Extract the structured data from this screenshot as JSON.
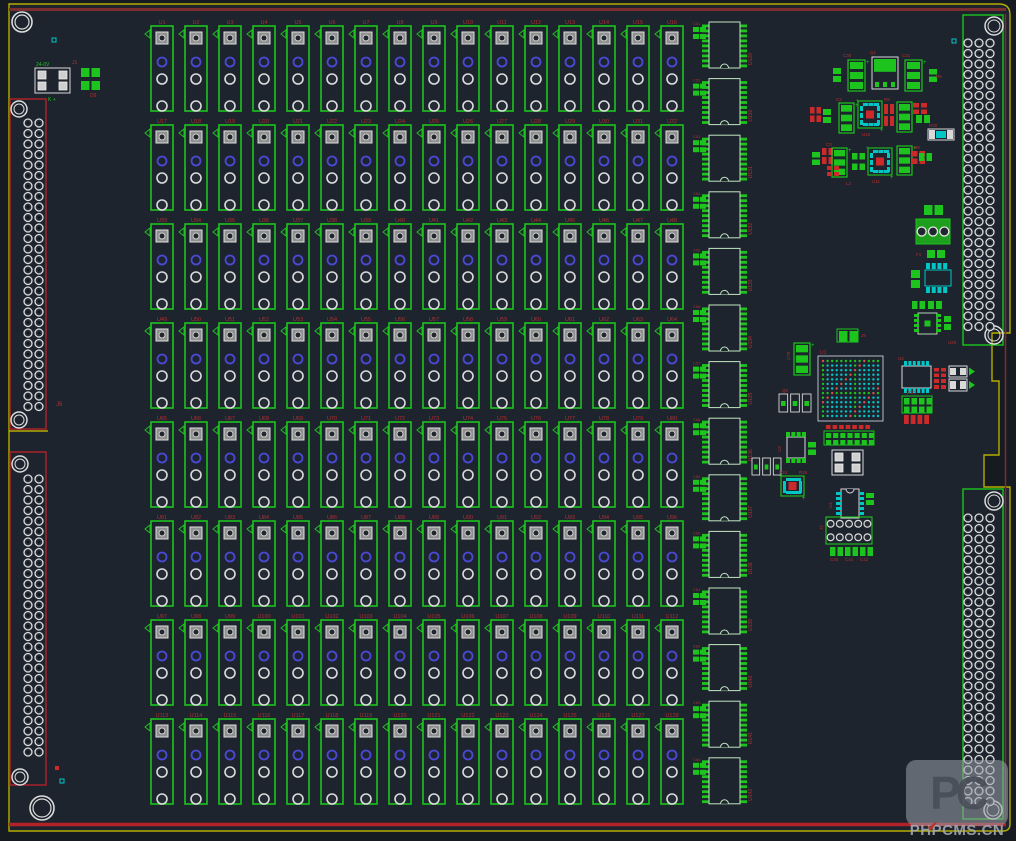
{
  "app": {
    "type": "pcb-layout-editor-canvas"
  },
  "colors": {
    "bg": "#1d242e",
    "outside": "#161b22",
    "green": "#1dc41d",
    "pale": "#c2e6c2",
    "cyan": "#00c6c6",
    "blue": "#4a49d6",
    "white": "#dcdcdc",
    "gray_pad": "#8f8f8f",
    "red_text": "#b03030",
    "red_pad": "#cc2a2a",
    "maroon": "#7c2e2e",
    "red_bright": "#b22228",
    "yellow": "#b5ab00",
    "body_outline": "#d9d9d9",
    "bga_outline": "#c9cfd6"
  },
  "watermark": {
    "logo": "PC",
    "text": "PHPCMS.CN"
  },
  "board": {
    "outline_yellow": "M 9 831 L 9 4 L 999 4 Q 1010 4 1010 15 L 1010 333 L 992 333 L 992 381 L 999 381 L 999 455 L 984 455 L 984 487 L 1010 487 L 1010 824 Q 1010 831 1003 831 Z",
    "notch_stub": "M 9 431 L 48 431",
    "red_top": [
      9,
      9.5,
      1006,
      9.5
    ],
    "red_bottom": [
      9,
      824.5,
      1006,
      824.5
    ],
    "red_right": [
      1005.5,
      14,
      1005.5,
      820
    ],
    "mount_holes": [
      [
        22,
        22,
        10
      ],
      [
        42,
        808,
        12
      ]
    ]
  },
  "relay_grid": {
    "cols": 16,
    "rows": 8,
    "x0": 151,
    "y0": 26,
    "col_pitch": 34,
    "row_pitch": 99,
    "box_w": 22,
    "box_h": 85,
    "ref_prefix": "U",
    "ref_start": 1
  },
  "dip_column": {
    "count": 14,
    "x": 709,
    "y0": 22,
    "pitch": 56.6,
    "body_w": 31,
    "body_h": 46,
    "pins_per_side": 9,
    "ref_prefix": "U",
    "ref_start": 129,
    "aux_prefix": "C",
    "aux_start": 51
  },
  "connectors": [
    {
      "name": "left-upper-connector",
      "box": [
        10,
        99,
        36,
        330
      ],
      "stroke": "red",
      "pad_cols": [
        28,
        39
      ],
      "pad_y0": 123,
      "pad_pitch": 10.5,
      "pad_rows": 28,
      "pad_r": 4,
      "holes": [
        [
          19,
          109,
          8
        ],
        [
          19,
          420,
          8
        ]
      ]
    },
    {
      "name": "left-lower-connector",
      "box": [
        10,
        452,
        36,
        333
      ],
      "stroke": "red",
      "pad_cols": [
        28,
        39
      ],
      "pad_y0": 479,
      "pad_pitch": 10.5,
      "pad_rows": 27,
      "pad_r": 4,
      "holes": [
        [
          20,
          464,
          8
        ],
        [
          20,
          777,
          8
        ]
      ]
    },
    {
      "name": "right-upper-connector",
      "box": [
        963,
        15,
        40,
        330
      ],
      "stroke": "green",
      "pad_cols": [
        968,
        979,
        990
      ],
      "pad_y0": 43,
      "pad_pitch": 10.5,
      "pad_rows": 28,
      "pad_r": 4,
      "holes": [
        [
          994,
          26,
          9
        ],
        [
          994,
          335,
          9
        ]
      ]
    },
    {
      "name": "right-lower-connector",
      "box": [
        963,
        489,
        40,
        330
      ],
      "stroke": "green",
      "pad_cols": [
        968,
        979,
        990
      ],
      "pad_y0": 518,
      "pad_pitch": 10.5,
      "pad_rows": 28,
      "pad_r": 4,
      "holes": [
        [
          994,
          501,
          9
        ],
        [
          993,
          810,
          9
        ]
      ]
    }
  ],
  "components": [
    {
      "t": "padbox4",
      "x": 35,
      "y": 68,
      "w": 35,
      "h": 25
    },
    {
      "t": "pads2x2g",
      "x": 79,
      "y": 66,
      "w": 23,
      "h": 26
    },
    {
      "t": "cap3v",
      "x": 848,
      "y": 60,
      "w": 17,
      "h": 31
    },
    {
      "t": "to252",
      "x": 872,
      "y": 57,
      "w": 26,
      "h": 32
    },
    {
      "t": "cap3v",
      "x": 905,
      "y": 60,
      "w": 17,
      "h": 31
    },
    {
      "t": "chip2gv",
      "x": 833,
      "y": 68,
      "w": 8,
      "h": 14
    },
    {
      "t": "chip2gv",
      "x": 929,
      "y": 69,
      "w": 8,
      "h": 13
    },
    {
      "t": "chip2r",
      "x": 810,
      "y": 107,
      "w": 11,
      "h": 15
    },
    {
      "t": "chip2gv",
      "x": 823,
      "y": 109,
      "w": 8,
      "h": 14
    },
    {
      "t": "cap3v",
      "x": 839,
      "y": 103,
      "w": 15,
      "h": 30
    },
    {
      "t": "qfncyan",
      "x": 858,
      "y": 101,
      "w": 24,
      "h": 27
    },
    {
      "t": "chip2r",
      "x": 884,
      "y": 104,
      "w": 10,
      "h": 22
    },
    {
      "t": "cap3v",
      "x": 897,
      "y": 102,
      "w": 15,
      "h": 30
    },
    {
      "t": "chip2r",
      "x": 913,
      "y": 103,
      "w": 14,
      "h": 11
    },
    {
      "t": "chip2gh",
      "x": 916,
      "y": 115,
      "w": 14,
      "h": 8
    },
    {
      "t": "rescyan",
      "x": 928,
      "y": 129,
      "w": 26,
      "h": 11
    },
    {
      "t": "chip2gv",
      "x": 812,
      "y": 152,
      "w": 8,
      "h": 13
    },
    {
      "t": "chip2r",
      "x": 822,
      "y": 148,
      "w": 11,
      "h": 16
    },
    {
      "t": "cap3v",
      "x": 832,
      "y": 148,
      "w": 15,
      "h": 29
    },
    {
      "t": "pads2x2g",
      "x": 850,
      "y": 151,
      "w": 17,
      "h": 21
    },
    {
      "t": "qfncyan",
      "x": 868,
      "y": 148,
      "w": 24,
      "h": 27
    },
    {
      "t": "cap3v",
      "x": 897,
      "y": 146,
      "w": 15,
      "h": 29
    },
    {
      "t": "chip2r",
      "x": 912,
      "y": 151,
      "w": 13,
      "h": 13
    },
    {
      "t": "chip2gh",
      "x": 919,
      "y": 153,
      "w": 13,
      "h": 8
    },
    {
      "t": "chip2r",
      "x": 827,
      "y": 166,
      "w": 12,
      "h": 10
    },
    {
      "t": "chip2gh",
      "x": 924,
      "y": 205,
      "w": 19,
      "h": 10
    },
    {
      "t": "term3",
      "x": 916,
      "y": 219,
      "w": 34,
      "h": 25
    },
    {
      "t": "chip2gh",
      "x": 927,
      "y": 250,
      "w": 18,
      "h": 8
    },
    {
      "t": "opto",
      "x": 925,
      "y": 263,
      "w": 26,
      "h": 30
    },
    {
      "t": "chip2gv",
      "x": 911,
      "y": 270,
      "w": 9,
      "h": 18
    },
    {
      "t": "qfn8g",
      "x": 914,
      "y": 311,
      "w": 27,
      "h": 25
    },
    {
      "t": "chip2gh",
      "x": 912,
      "y": 301,
      "w": 13,
      "h": 8
    },
    {
      "t": "chip2gh",
      "x": 928,
      "y": 301,
      "w": 14,
      "h": 8
    },
    {
      "t": "chip2gv",
      "x": 944,
      "y": 316,
      "w": 7,
      "h": 14
    },
    {
      "t": "cap3v",
      "x": 794,
      "y": 343,
      "w": 16,
      "h": 32
    },
    {
      "t": "hdr",
      "x": 837,
      "y": 329,
      "w": 21,
      "h": 13,
      "cols": 2,
      "rows": 1
    },
    {
      "t": "bga",
      "x": 818,
      "y": 356,
      "w": 65,
      "h": 65
    },
    {
      "t": "soiccy_tb",
      "x": 902,
      "y": 361,
      "w": 29,
      "h": 32
    },
    {
      "t": "chip2r",
      "x": 934,
      "y": 368,
      "w": 12,
      "h": 9
    },
    {
      "t": "chip2r",
      "x": 934,
      "y": 379,
      "w": 12,
      "h": 10
    },
    {
      "t": "diode",
      "x": 949,
      "y": 366,
      "w": 26,
      "h": 11
    },
    {
      "t": "diode",
      "x": 949,
      "y": 379,
      "w": 26,
      "h": 12
    },
    {
      "t": "hdr",
      "x": 902,
      "y": 396,
      "w": 30,
      "h": 17,
      "cols": 4,
      "rows": 2
    },
    {
      "t": "redrow",
      "x": 904,
      "y": 415,
      "w": 27,
      "h": 9,
      "n": 4
    },
    {
      "t": "tab3",
      "x": 779,
      "y": 394,
      "w": 32,
      "h": 18
    },
    {
      "t": "hdr",
      "x": 824,
      "y": 431,
      "w": 50,
      "h": 14,
      "cols": 7,
      "rows": 2
    },
    {
      "t": "redrow",
      "x": 826,
      "y": 425,
      "w": 46,
      "h": 4,
      "n": 7
    },
    {
      "t": "soicg_tb",
      "x": 785,
      "y": 432,
      "w": 22,
      "h": 31
    },
    {
      "t": "chip2gv",
      "x": 808,
      "y": 442,
      "w": 8,
      "h": 13
    },
    {
      "t": "tab3",
      "x": 752,
      "y": 458,
      "w": 29,
      "h": 17
    },
    {
      "t": "padbox4",
      "x": 832,
      "y": 450,
      "w": 31,
      "h": 25
    },
    {
      "t": "qfncyan",
      "x": 781,
      "y": 476,
      "w": 23,
      "h": 20
    },
    {
      "t": "soiccy_lr",
      "x": 836,
      "y": 489,
      "w": 28,
      "h": 29
    },
    {
      "t": "chip2gv",
      "x": 866,
      "y": 493,
      "w": 8,
      "h": 12
    },
    {
      "t": "hdrc",
      "x": 826,
      "y": 517,
      "w": 46,
      "h": 27,
      "cols": 5,
      "rows": 2
    },
    {
      "t": "chip2gh",
      "x": 830,
      "y": 547,
      "w": 13,
      "h": 9
    },
    {
      "t": "chip2gh",
      "x": 845,
      "y": 547,
      "w": 13,
      "h": 9
    },
    {
      "t": "chip2gh",
      "x": 860,
      "y": 547,
      "w": 13,
      "h": 9
    },
    {
      "t": "cyansq",
      "x": 52,
      "y": 38
    },
    {
      "t": "cyansq",
      "x": 952,
      "y": 39
    },
    {
      "t": "cyansq",
      "x": 60,
      "y": 779
    },
    {
      "t": "redsq",
      "x": 55,
      "y": 766
    }
  ],
  "silk_labels": [
    {
      "t": "24-0V",
      "x": 36,
      "y": 66,
      "c": "green",
      "s": 5
    },
    {
      "t": "K +",
      "x": 48,
      "y": 101,
      "c": "green",
      "s": 5
    },
    {
      "t": "J1",
      "x": 72,
      "y": 64,
      "c": "red",
      "s": 5
    },
    {
      "t": "D9",
      "x": 90,
      "y": 97,
      "c": "red",
      "s": 5
    },
    {
      "t": "J6",
      "x": 56,
      "y": 406,
      "c": "red",
      "s": 6
    },
    {
      "t": "C30",
      "x": 843,
      "y": 57,
      "c": "red",
      "s": 4.5
    },
    {
      "t": "Q1",
      "x": 870,
      "y": 54,
      "c": "red",
      "s": 4.5
    },
    {
      "t": "C31",
      "x": 902,
      "y": 57,
      "c": "red",
      "s": 4.5
    },
    {
      "t": "R5",
      "x": 936,
      "y": 78,
      "c": "red",
      "s": 4.5
    },
    {
      "t": "C2",
      "x": 836,
      "y": 101,
      "c": "red",
      "s": 4.5
    },
    {
      "t": "U10",
      "x": 862,
      "y": 136,
      "c": "red",
      "s": 4.5
    },
    {
      "t": "R8",
      "x": 884,
      "y": 101,
      "c": "red",
      "s": 4.5
    },
    {
      "t": "R30",
      "x": 929,
      "y": 127,
      "c": "red",
      "s": 4.5
    },
    {
      "t": "C3",
      "x": 826,
      "y": 146,
      "c": "red",
      "s": 4.5
    },
    {
      "t": "U11",
      "x": 872,
      "y": 183,
      "c": "red",
      "s": 4.5
    },
    {
      "t": "L2",
      "x": 846,
      "y": 185,
      "c": "red",
      "s": 4.5
    },
    {
      "t": "R9",
      "x": 914,
      "y": 149,
      "c": "red",
      "s": 4.5
    },
    {
      "t": "F1",
      "x": 916,
      "y": 256,
      "c": "red",
      "s": 4.5
    },
    {
      "t": "U20",
      "x": 948,
      "y": 344,
      "c": "red",
      "s": 4.5
    },
    {
      "t": "J9",
      "x": 861,
      "y": 337,
      "c": "red",
      "s": 4.5
    },
    {
      "t": "C70",
      "x": 790,
      "y": 360,
      "c": "red",
      "s": 4.5,
      "r": -90
    },
    {
      "t": "U1",
      "x": 820,
      "y": 354,
      "c": "red",
      "s": 5
    },
    {
      "t": "U2",
      "x": 898,
      "y": 360,
      "c": "red",
      "s": 4.5
    },
    {
      "t": "VCC",
      "x": 906,
      "y": 394,
      "c": "red",
      "s": 4.5
    },
    {
      "t": "Q5",
      "x": 782,
      "y": 392,
      "c": "red",
      "s": 4.5
    },
    {
      "t": "U3",
      "x": 781,
      "y": 452,
      "c": "red",
      "s": 4.5,
      "r": -90
    },
    {
      "t": "R24",
      "x": 779,
      "y": 474,
      "c": "red",
      "s": 4.5
    },
    {
      "t": "R26",
      "x": 799,
      "y": 474,
      "c": "red",
      "s": 4.5
    },
    {
      "t": "U4",
      "x": 832,
      "y": 508,
      "c": "red",
      "s": 4.5,
      "r": -90
    },
    {
      "t": "J2",
      "x": 823,
      "y": 530,
      "c": "red",
      "s": 4.5,
      "r": -90
    },
    {
      "t": "C40",
      "x": 830,
      "y": 561,
      "c": "red",
      "s": 4.5
    },
    {
      "t": "C41",
      "x": 845,
      "y": 561,
      "c": "red",
      "s": 4.5
    },
    {
      "t": "C42",
      "x": 860,
      "y": 561,
      "c": "red",
      "s": 4.5
    }
  ]
}
